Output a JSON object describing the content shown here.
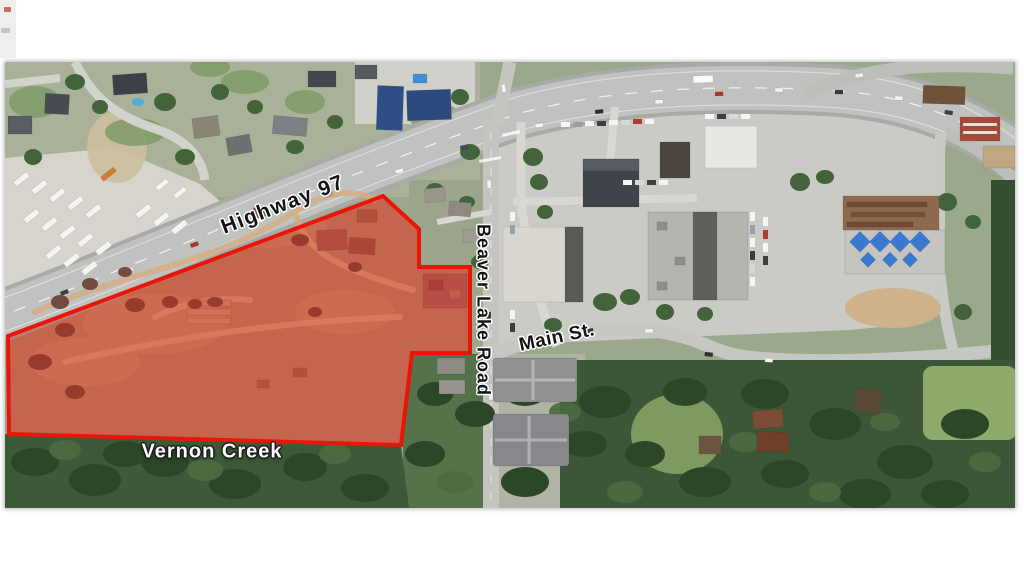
{
  "page": {
    "type": "aerial-map-figure",
    "background": "#ffffff"
  },
  "map": {
    "description": "Satellite aerial photograph with a highlighted development parcel outlined in red beside Highway 97",
    "labels": {
      "highway": "Highway 97",
      "beaver_lake_road": "Beaver Lake Road",
      "main_st": "Main St.",
      "vernon_creek": "Vernon Creek"
    },
    "parcel": {
      "name": "highlighted-parcel",
      "outline_color": "#ea1509",
      "fill_color": "rgba(228,30,20,0.33)"
    }
  }
}
